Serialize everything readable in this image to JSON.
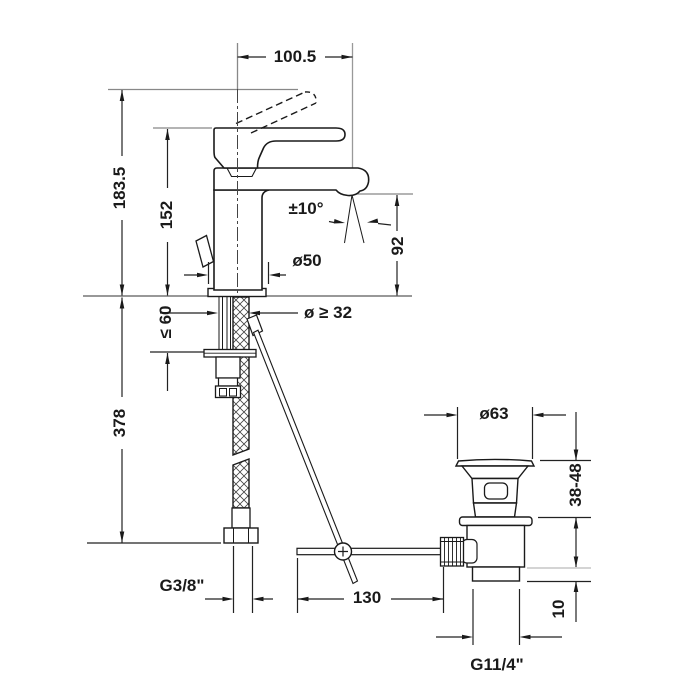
{
  "labels": {
    "spout_reach": "100.5",
    "overall_height": "183.5",
    "fitting_height": "152",
    "swivel_angle": "±10°",
    "spout_height": "92",
    "base_diameter": "ø50",
    "hole_diameter": "ø ≥ 32",
    "max_counter_thickness": "≤ 60",
    "supply_hose_length": "378",
    "supply_thread": "G3/8\"",
    "rod_offset": "130",
    "waste_flange_diameter": "ø63",
    "basin_thickness": "38-48",
    "tailpiece_length": "10",
    "waste_thread": "G11/4\""
  }
}
